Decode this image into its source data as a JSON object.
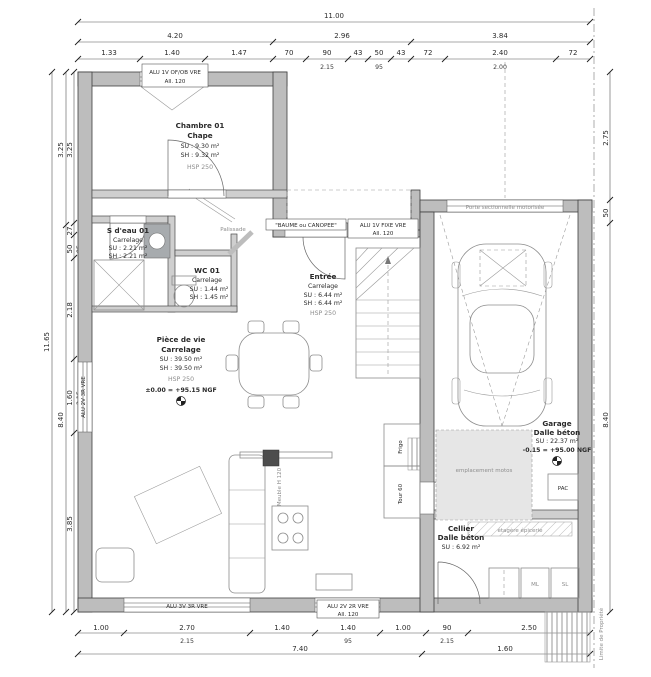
{
  "dims": {
    "top1": "11.00",
    "top2": [
      "4.20",
      "2.96",
      "3.84"
    ],
    "top3": [
      {
        "v": "1.33"
      },
      {
        "v": "1.40",
        "sub": "95"
      },
      {
        "v": "1.47"
      },
      {
        "v": "70"
      },
      {
        "v": "90",
        "sub": "2.15"
      },
      {
        "v": "43"
      },
      {
        "v": "50",
        "sub": "95"
      },
      {
        "v": "43"
      },
      {
        "v": "72"
      },
      {
        "v": "2.40",
        "sub": "2.00"
      },
      {
        "v": "72"
      }
    ],
    "left1": "11.65",
    "left2": [
      "3.25",
      "8.40"
    ],
    "left3": [
      {
        "v": "3.25"
      },
      {
        "v": "27"
      },
      {
        "v": "50",
        "sub": "95"
      },
      {
        "v": "2.18"
      },
      {
        "v": "1.60",
        "sub": "2.15"
      },
      {
        "v": "3.85"
      }
    ],
    "right": [
      "2.75",
      "50",
      "8.40"
    ],
    "bottom1": [
      {
        "v": "1.00"
      },
      {
        "v": "2.70",
        "sub": "2.15"
      },
      {
        "v": "1.40"
      },
      {
        "v": "1.40",
        "sub": "95"
      },
      {
        "v": "1.00"
      },
      {
        "v": "90",
        "sub": "2.15"
      },
      {
        "v": "2.50"
      }
    ],
    "bottom2": [
      "7.40",
      "1.60"
    ]
  },
  "rooms": {
    "chambre": {
      "name": "Chambre 01",
      "floor": "Chape",
      "su": "SU : 9.30 m²",
      "sh": "SH : 9.32 m²",
      "hsp": "HSP 250"
    },
    "sdeau": {
      "name": "S d'eau 01",
      "floor": "Carrelage",
      "su": "SU : 2.21 m²",
      "sh": "SH : 2.21 m²"
    },
    "wc": {
      "name": "WC 01",
      "floor": "Carrelage",
      "su": "SU : 1.44 m²",
      "sh": "SH : 1.45 m²"
    },
    "entree": {
      "name": "Entrée",
      "floor": "Carrelage",
      "su": "SU : 6.44 m²",
      "sh": "SH : 6.44 m²",
      "hsp": "HSP 250"
    },
    "piece": {
      "name": "Pièce de vie",
      "floor": "Carrelage",
      "su": "SU : 39.50 m²",
      "sh": "SH : 39.50 m²",
      "hsp": "HSP 250",
      "level": "±0.00 = +95.15 NGF"
    },
    "garage": {
      "name": "Garage",
      "floor": "Dalle béton",
      "su": "SU : 22.37 m²",
      "level": "-0.15 = +95.00 NGF"
    },
    "cellier": {
      "name": "Cellier",
      "floor": "Dalle béton",
      "su": "SU : 6.92 m²"
    }
  },
  "openings": {
    "chambre_window": "ALU 1V OF/OB VRE",
    "chambre_window_sill": "All. 120",
    "entry_door": "\"BAUME ou CANOPEE\"",
    "entry_fixed": "ALU 1V FIXE VRE",
    "entry_fixed_sill": "All. 120",
    "garage_door": "Porte sectionnelle motorisée",
    "left_window": "ALU 2V 3R VRE",
    "bottom_window_big": "ALU 3V 3R VRE",
    "bottom_window_kitchen": "ALU 2V 2R VRE",
    "bottom_window_kitchen_sill": "All. 120"
  },
  "annotations": {
    "motos": "emplacement motos",
    "pac": "PAC",
    "ml": "ML",
    "sl": "SL",
    "shelf": "étagère épicerie",
    "frigo": "Frigo",
    "tour": "Tour 60",
    "meuble": "Meuble H 120",
    "palissade": "Palissade",
    "limite": "Limite de Propriété"
  }
}
